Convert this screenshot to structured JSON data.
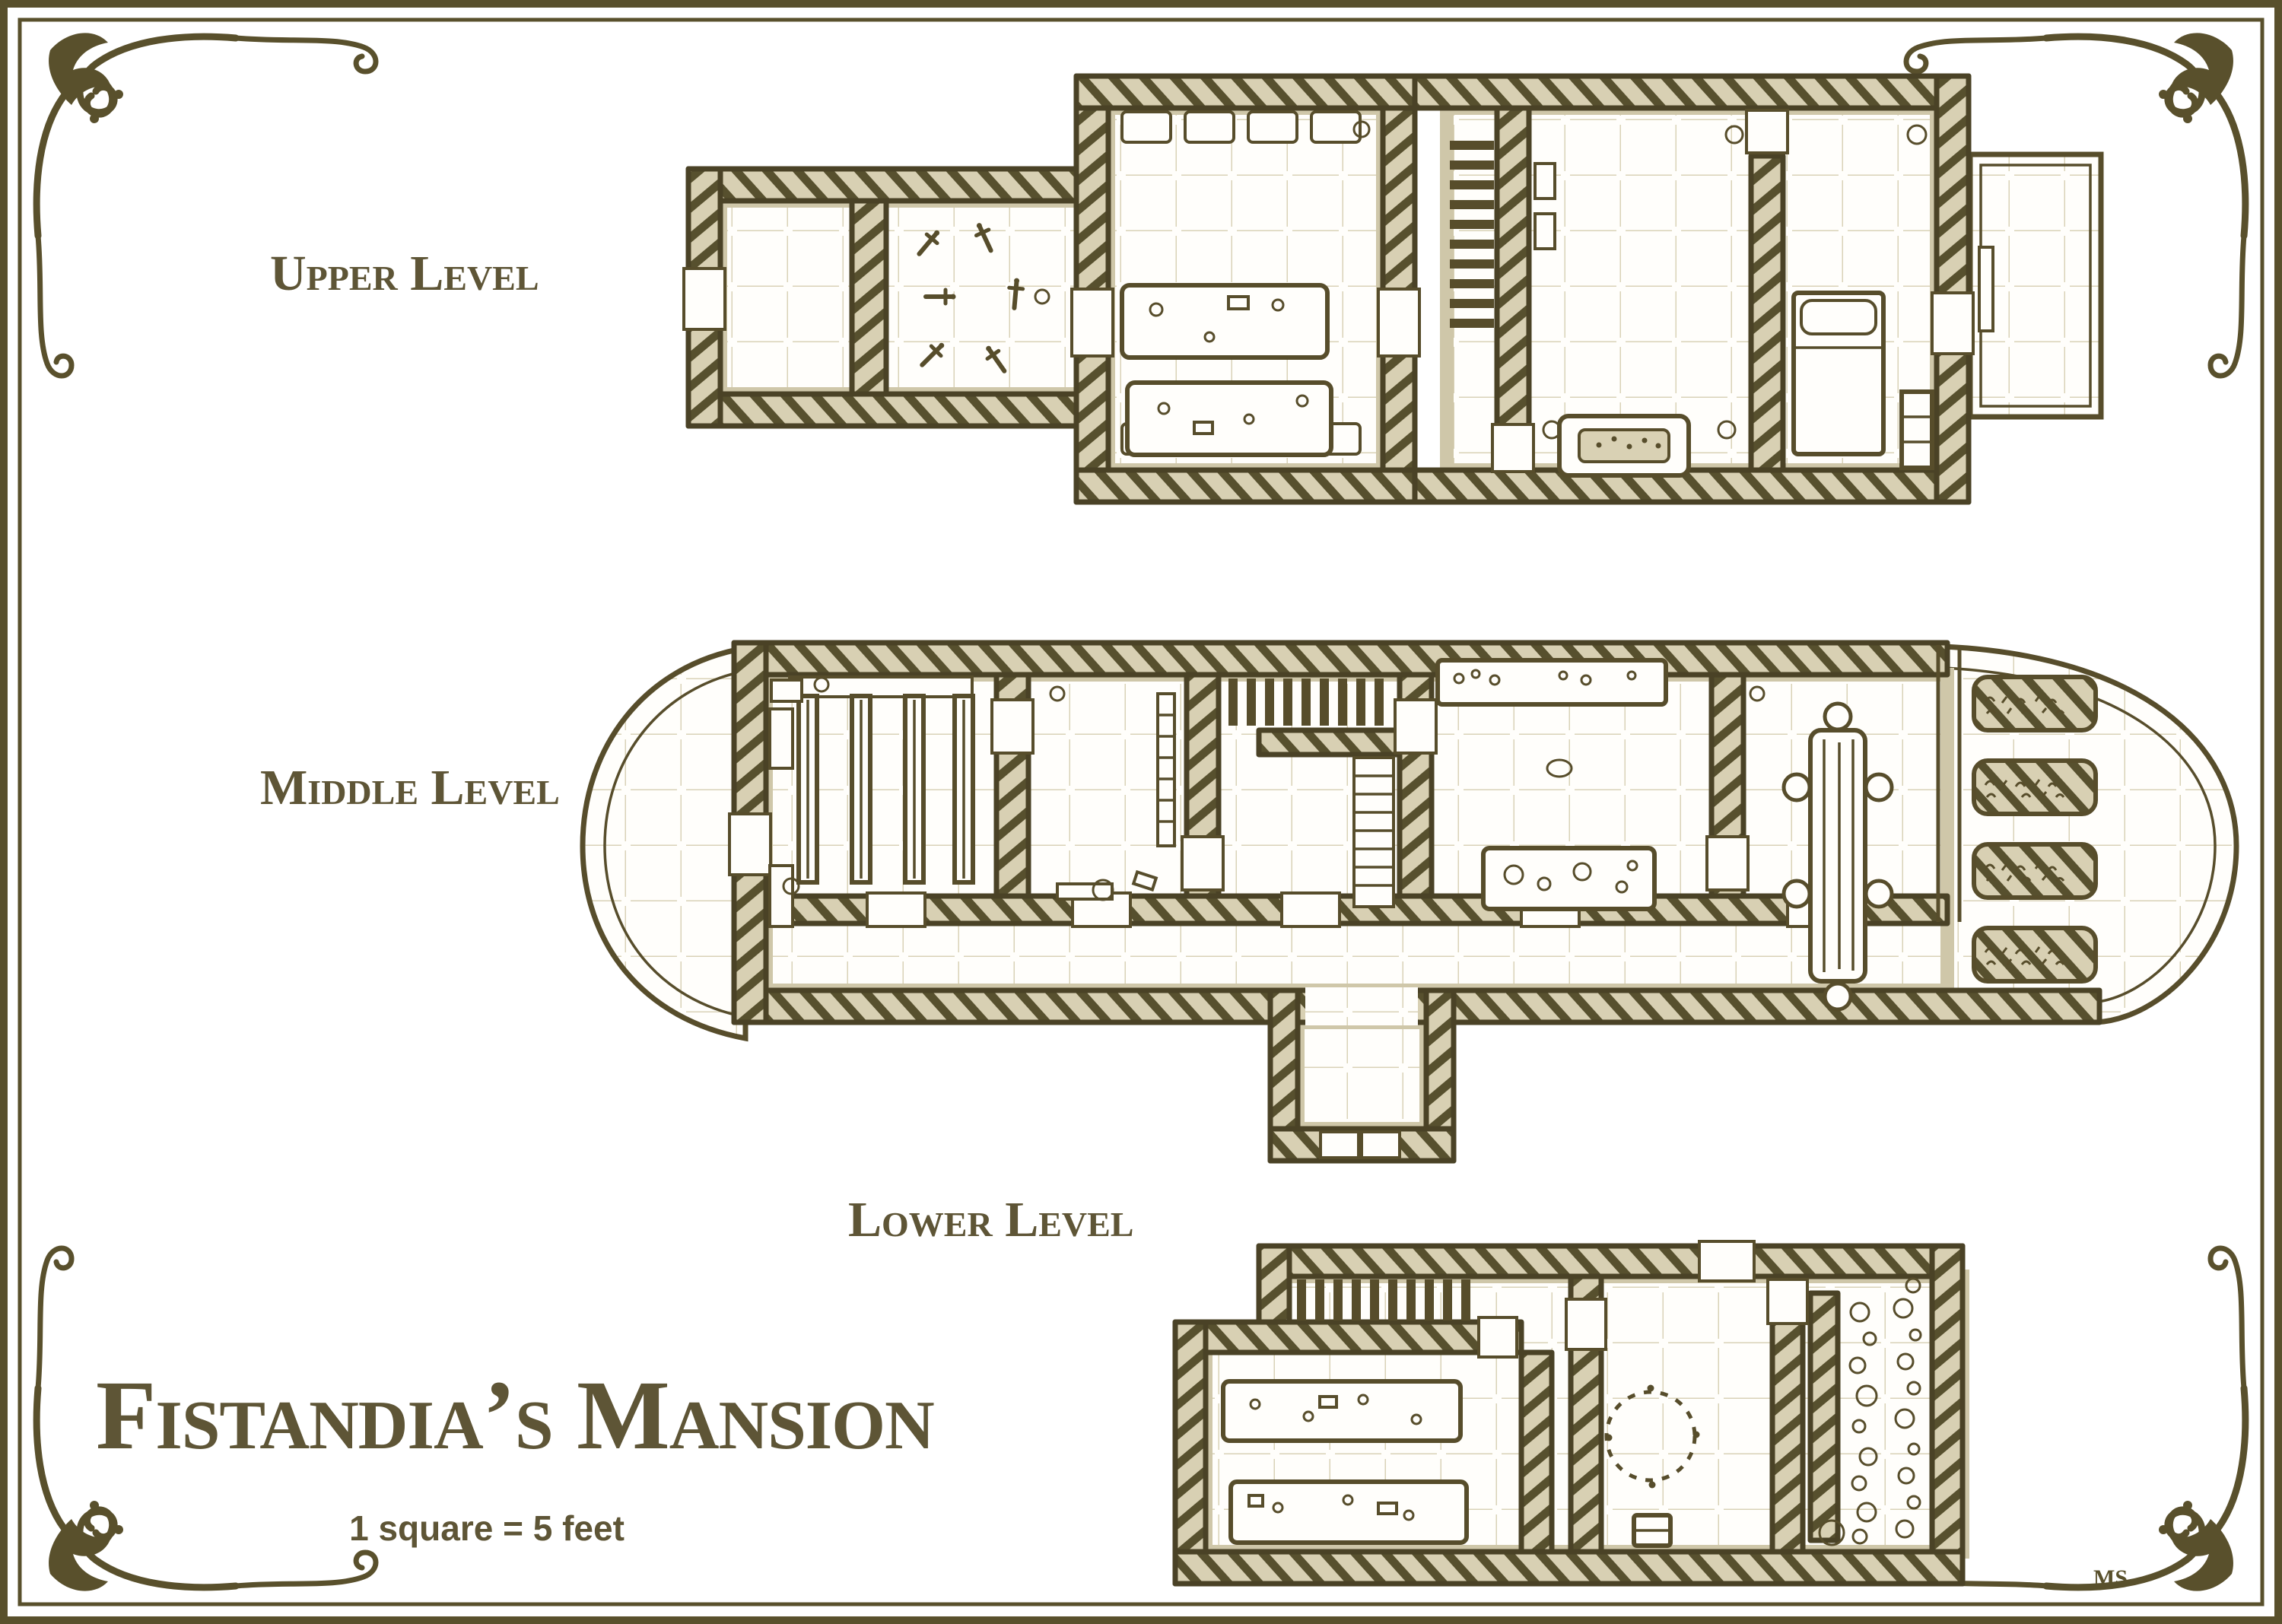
{
  "title": "Fistandia’s Mansion",
  "scale_note": "1 square = 5 feet",
  "signature": "MS",
  "levels": [
    {
      "id": "upper",
      "label": "Upper Level",
      "features": [
        "hall",
        "armory-daggers",
        "great-hall",
        "benches",
        "long-tables",
        "staircase",
        "sitting-room",
        "fireplace",
        "bedroom",
        "bed",
        "wardrobe",
        "balcony"
      ]
    },
    {
      "id": "middle",
      "label": "Middle Level",
      "features": [
        "porch-balcony",
        "library",
        "bookshelves",
        "study",
        "grand-staircase",
        "kitchen",
        "sideboard",
        "counter",
        "dining-room",
        "dining-table",
        "garden-balcony",
        "garden-beds",
        "corridor",
        "entry-vestibule"
      ]
    },
    {
      "id": "lower",
      "label": "Lower Level",
      "features": [
        "staircase",
        "workshop",
        "work-tables",
        "ritual-circle",
        "chest",
        "storage",
        "jars-and-barrels"
      ]
    }
  ],
  "grid": {
    "feet_per_square": 5
  },
  "colors": {
    "ink": "#564c2b",
    "wall_fill": "#d8d0b3",
    "grid_line": "#d9d2b7",
    "floor": "#fffefb",
    "shadow": "#cfc7a9",
    "frame": "#59502c",
    "text": "#5e5536",
    "paper": "#ffffff"
  }
}
